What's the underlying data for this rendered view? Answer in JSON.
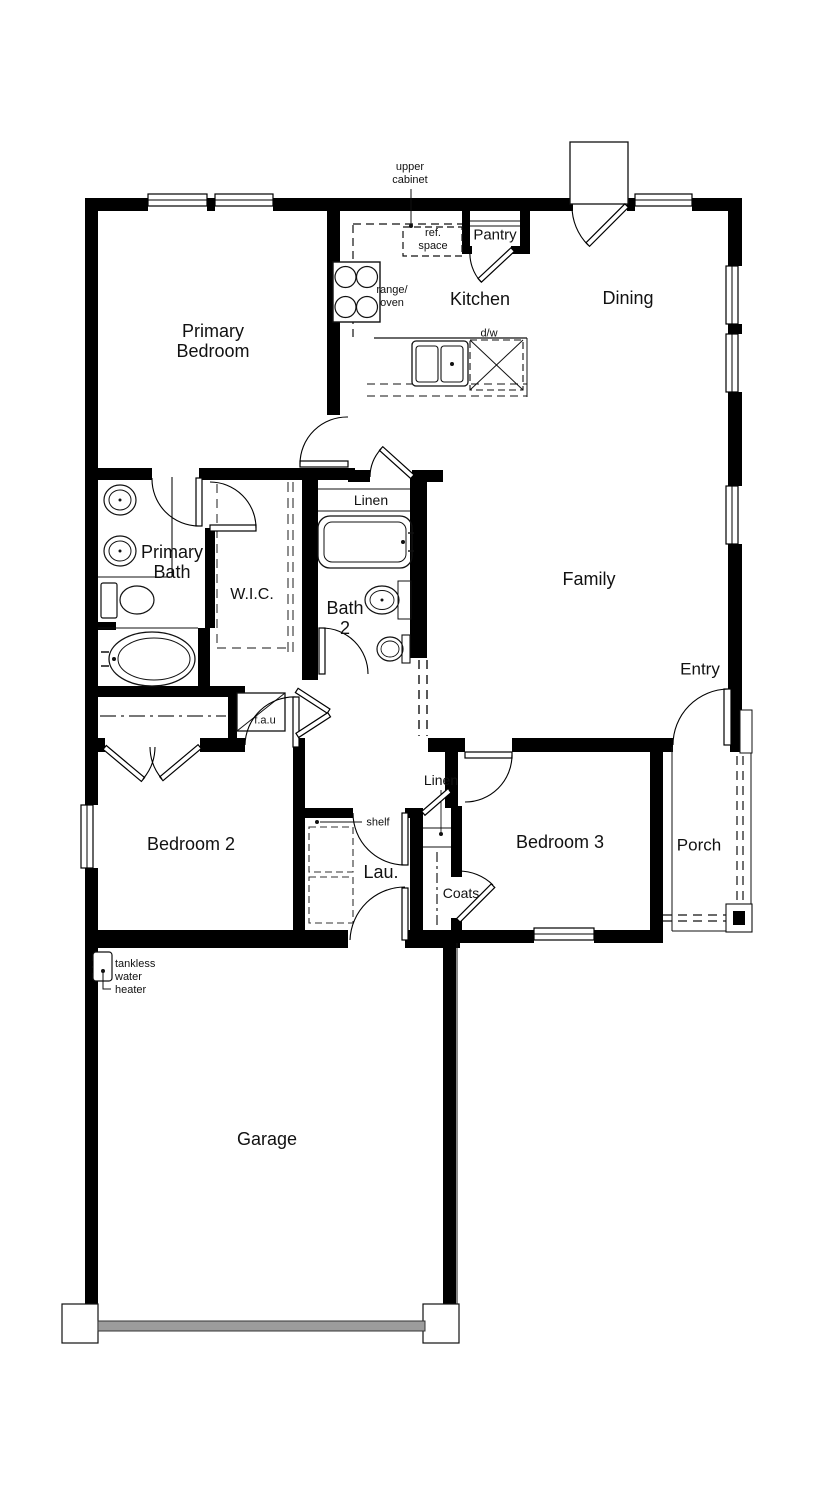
{
  "plan": {
    "title": "single-story-floor-plan",
    "rooms": {
      "primary_bedroom": {
        "label": "Primary\nBedroom"
      },
      "kitchen": {
        "label": "Kitchen"
      },
      "dining": {
        "label": "Dining"
      },
      "pantry": {
        "label": "Pantry"
      },
      "family": {
        "label": "Family"
      },
      "entry": {
        "label": "Entry"
      },
      "primary_bath": {
        "label": "Primary\nBath"
      },
      "wic": {
        "label": "W.I.C."
      },
      "linen_upper": {
        "label": "Linen"
      },
      "bath2": {
        "label": "Bath\n2"
      },
      "bedroom2": {
        "label": "Bedroom 2"
      },
      "bedroom3": {
        "label": "Bedroom 3"
      },
      "laundry": {
        "label": "Lau."
      },
      "linen_lower": {
        "label": "Linen"
      },
      "coats": {
        "label": "Coats"
      },
      "porch": {
        "label": "Porch"
      },
      "garage": {
        "label": "Garage"
      }
    },
    "annotations": {
      "upper_cabinet": "upper\ncabinet",
      "ref_space": "ref.\nspace",
      "range_oven": "range/\noven",
      "dishwasher": "d/w",
      "fau": "f.a.u",
      "shelf": "shelf",
      "tankless": "tankless\nwater\nheater"
    },
    "colors": {
      "wall": "#000000",
      "line": "#1a1a1a",
      "dash": "#444444",
      "rod_dash": "#777777",
      "garage_door": "#9c9c9c",
      "background": "#ffffff"
    }
  }
}
